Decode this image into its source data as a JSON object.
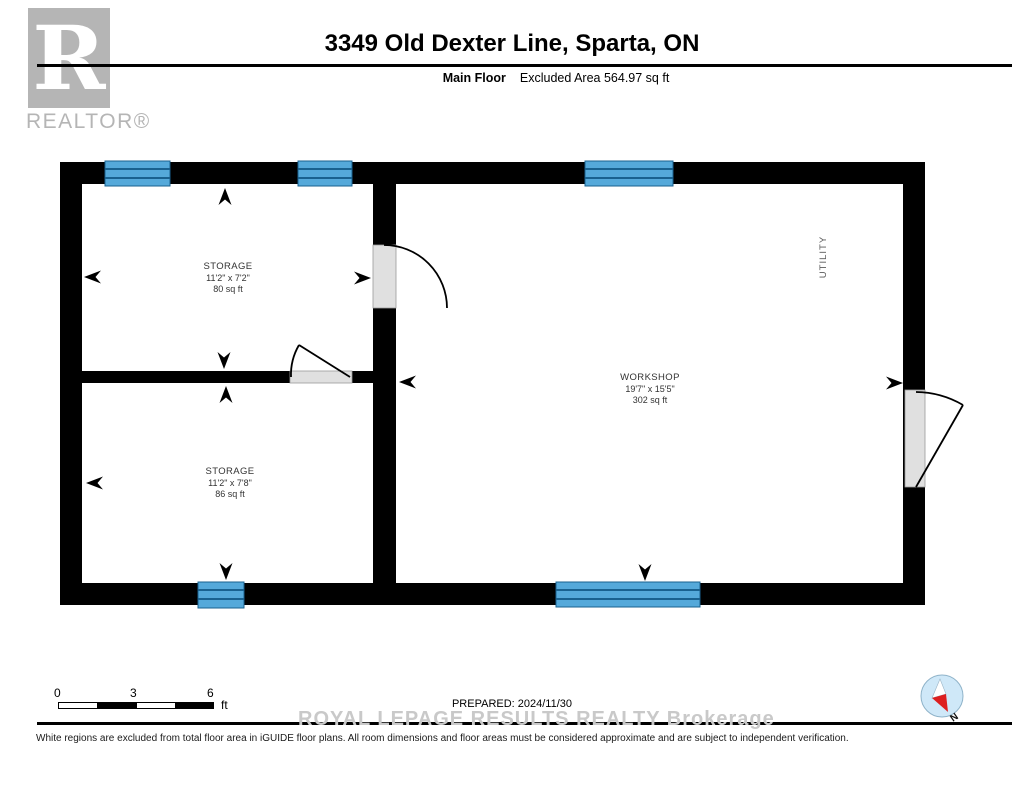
{
  "header": {
    "title": "3349 Old Dexter Line, Sparta, ON",
    "floor_label": "Main Floor",
    "excluded_area_label": "Excluded Area 564.97 sq ft"
  },
  "logo": {
    "letter": "R",
    "brand": "REALTOR®"
  },
  "floorplan": {
    "rooms": [
      {
        "name": "STORAGE",
        "dimensions": "11'2\" x 7'2\"",
        "area": "80 sq ft"
      },
      {
        "name": "STORAGE",
        "dimensions": "11'2\" x 7'8\"",
        "area": "86 sq ft"
      },
      {
        "name": "WORKSHOP",
        "dimensions": "19'7\" x 15'5\"",
        "area": "302 sq ft"
      },
      {
        "name": "UTILITY"
      }
    ]
  },
  "scale_bar": {
    "tick_start": "0",
    "tick_mid": "3",
    "tick_end": "6",
    "unit": "ft"
  },
  "compass": {
    "north_label": "N"
  },
  "footer": {
    "prepared_label": "PREPARED: 2024/11/30",
    "watermark": "ROYAL LEPAGE RESULTS REALTY Brokerage",
    "disclaimer": "White regions are excluded from total floor area in iGUIDE floor plans. All room dimensions and floor areas must be considered approximate and are subject to independent verification."
  },
  "colors": {
    "wall": "#000000",
    "window_fill": "#55a9da",
    "window_line": "#19618f",
    "door_fill": "#e0e0e0",
    "logo_gray": "#b5b5b5",
    "watermark_gray": "#c9c9c9",
    "label_text": "#333333",
    "compass_fill": "#cfe8f8",
    "compass_red": "#dd1f1f"
  }
}
